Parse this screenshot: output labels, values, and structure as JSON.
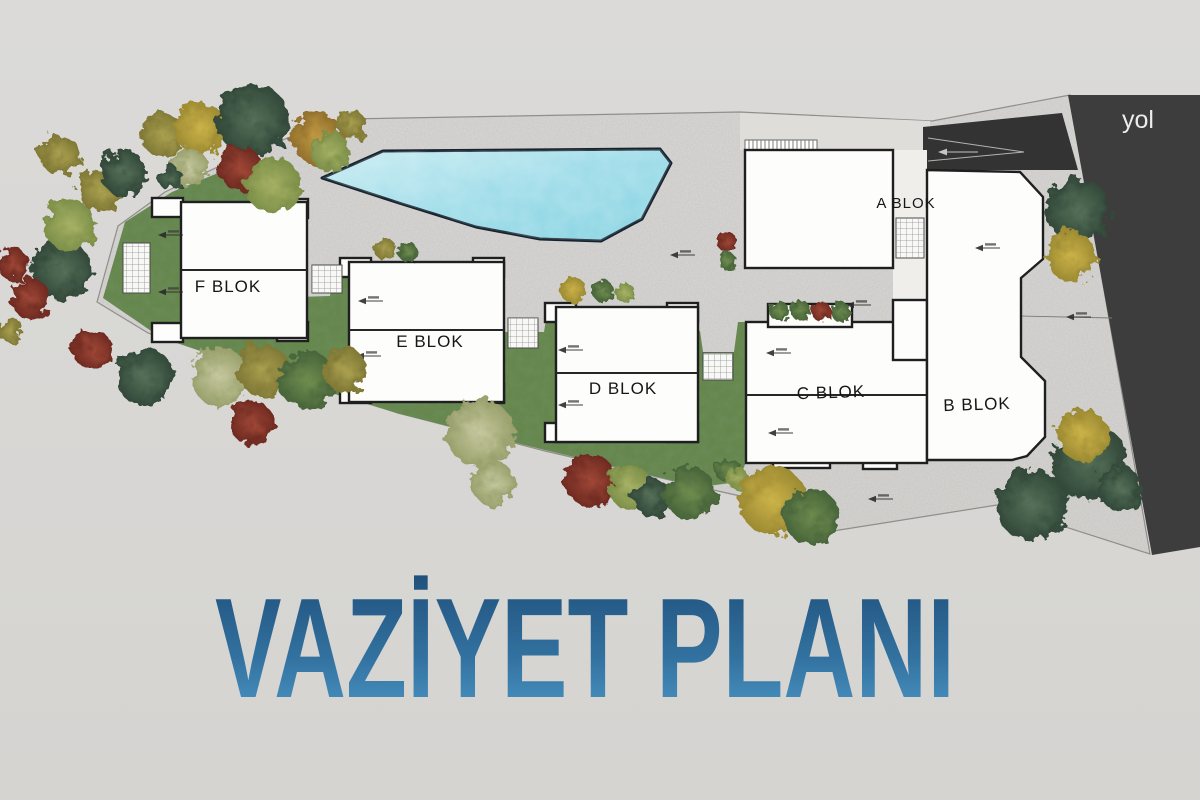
{
  "title": "VAZİYET PLANI",
  "road": {
    "label": "yol"
  },
  "blocks": [
    {
      "id": "A",
      "label": "A BLOK"
    },
    {
      "id": "B",
      "label": "B BLOK"
    },
    {
      "id": "C",
      "label": "C BLOK"
    },
    {
      "id": "D",
      "label": "D BLOK"
    },
    {
      "id": "E",
      "label": "E BLOK"
    },
    {
      "id": "F",
      "label": "F BLOK"
    }
  ],
  "colors": {
    "background": "#d8d7d4",
    "paving": "#cac7c2",
    "grass": "#64854a",
    "pool": "#8fd4e4",
    "road": "#3d3d3d",
    "ramp": "#333333",
    "building_fill": "#fdfdfc",
    "building_outline": "#1f1f1f",
    "label_color": "#161616",
    "road_label_color": "#ececec",
    "title_gradient_top": "#1f4e7a",
    "title_gradient_bottom": "#4f9bca"
  }
}
